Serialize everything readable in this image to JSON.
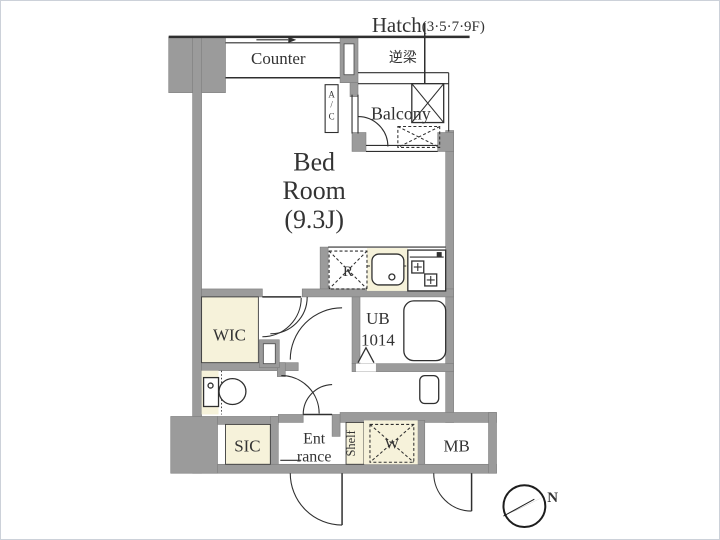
{
  "colors": {
    "wall": "#9b9b9b",
    "line": "#2f2f2f",
    "cream": "#f6f2da",
    "text": "#333333",
    "background": "#ffffff",
    "border": "#ccd1d9"
  },
  "annotations": {
    "hatch": "Hatch",
    "hatch_floors": "(3·5·7·9F)",
    "reverse_beam": "逆梁",
    "north": "N"
  },
  "rooms": {
    "bedroom": {
      "line1": "Bed",
      "line2": "Room",
      "line3": "(9.3J)"
    },
    "balcony": {
      "label": "Balcony"
    },
    "wic": {
      "label": "WIC"
    },
    "unit_bath": {
      "line1": "UB",
      "line2": "1014"
    },
    "entrance": {
      "line1": "Ent",
      "line2": "rance"
    },
    "sic": {
      "label": "SIC"
    },
    "meter_box": {
      "label": "MB"
    }
  },
  "fixtures": {
    "counter": {
      "label": "Counter"
    },
    "air_conditioner": {
      "char1": "A",
      "char2": "/",
      "char3": "C"
    },
    "refrigerator": {
      "label": "R"
    },
    "washing_machine": {
      "label": "W"
    },
    "shelf": {
      "label": "Shelf"
    }
  }
}
